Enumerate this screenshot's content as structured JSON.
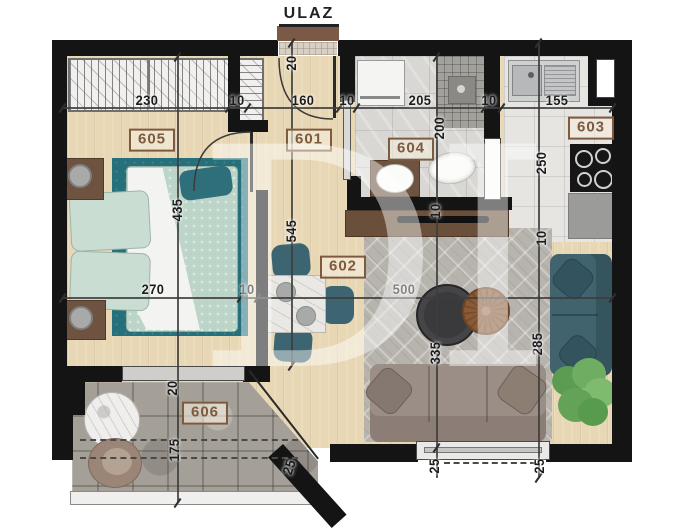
{
  "entrance": {
    "label": "ULAZ"
  },
  "watermark": {
    "text": "DI"
  },
  "rooms": [
    {
      "id": "605",
      "x": 152,
      "y": 140
    },
    {
      "id": "601",
      "x": 309,
      "y": 140
    },
    {
      "id": "604",
      "x": 411,
      "y": 149
    },
    {
      "id": "603",
      "x": 591,
      "y": 128
    },
    {
      "id": "602",
      "x": 343,
      "y": 267
    },
    {
      "id": "606",
      "x": 205,
      "y": 413
    }
  ],
  "dimensions": [
    {
      "text": "230",
      "x": 147,
      "y": 100,
      "rot": 0
    },
    {
      "text": "10",
      "x": 237,
      "y": 100,
      "rot": 0
    },
    {
      "text": "160",
      "x": 303,
      "y": 100,
      "rot": 0
    },
    {
      "text": "10",
      "x": 347,
      "y": 100,
      "rot": 0
    },
    {
      "text": "205",
      "x": 420,
      "y": 100,
      "rot": 0
    },
    {
      "text": "10",
      "x": 489,
      "y": 100,
      "rot": 0
    },
    {
      "text": "155",
      "x": 557,
      "y": 100,
      "rot": 0
    },
    {
      "text": "20",
      "x": 291,
      "y": 63,
      "rot": -90
    },
    {
      "text": "435",
      "x": 177,
      "y": 210,
      "rot": -90
    },
    {
      "text": "545",
      "x": 291,
      "y": 231,
      "rot": -90
    },
    {
      "text": "200",
      "x": 439,
      "y": 128,
      "rot": -90
    },
    {
      "text": "250",
      "x": 541,
      "y": 163,
      "rot": -90
    },
    {
      "text": "10",
      "x": 435,
      "y": 211,
      "rot": -90
    },
    {
      "text": "10",
      "x": 541,
      "y": 238,
      "rot": -90
    },
    {
      "text": "270",
      "x": 153,
      "y": 289,
      "rot": 0
    },
    {
      "text": "10",
      "x": 247,
      "y": 289,
      "rot": 0
    },
    {
      "text": "500",
      "x": 404,
      "y": 289,
      "rot": 0
    },
    {
      "text": "335",
      "x": 435,
      "y": 353,
      "rot": -90
    },
    {
      "text": "285",
      "x": 537,
      "y": 344,
      "rot": -90
    },
    {
      "text": "20",
      "x": 172,
      "y": 388,
      "rot": -90
    },
    {
      "text": "175",
      "x": 174,
      "y": 450,
      "rot": -90
    },
    {
      "text": "25",
      "x": 289,
      "y": 467,
      "rot": -72
    },
    {
      "text": "25",
      "x": 434,
      "y": 466,
      "rot": -90
    },
    {
      "text": "25",
      "x": 539,
      "y": 466,
      "rot": -90
    }
  ],
  "colors": {
    "wall": "#141414",
    "wood_floor": "#e8d7b4",
    "stone_terrace": "#a49f97",
    "label_brown": "#7d5a3e",
    "entrance_door_brown": "#7a5947",
    "sofa_teal": "#40636e",
    "sofa_gray": "#9b8e86",
    "bed_mint": "#bcd5c8",
    "bed_rug_teal": "#26707b"
  }
}
